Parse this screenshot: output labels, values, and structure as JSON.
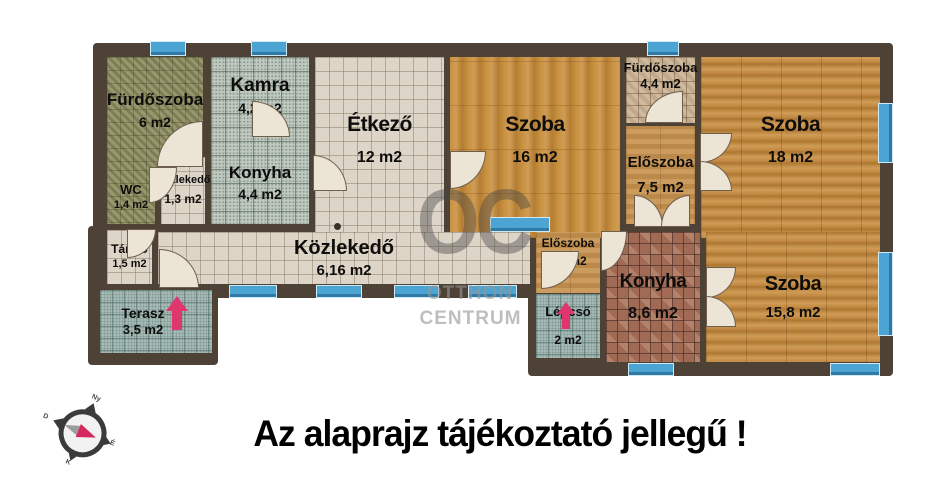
{
  "plan": {
    "rooms": {
      "furdoszoba6": {
        "name": "Fürdőszoba",
        "area": "6 m2"
      },
      "kamra": {
        "name": "Kamra",
        "area": "4,2 m2"
      },
      "etkezo": {
        "name": "Étkező",
        "area": "12 m2"
      },
      "szoba16": {
        "name": "Szoba",
        "area": "16 m2"
      },
      "furdoszoba44": {
        "name": "Fürdőszoba",
        "area": "4,4 m2"
      },
      "szoba18": {
        "name": "Szoba",
        "area": "18 m2"
      },
      "wc": {
        "name": "WC",
        "area": "1,4 m2"
      },
      "kozlekedo13": {
        "name": "Közlekedő",
        "area": "1,3 m2"
      },
      "konyha44": {
        "name": "Konyha",
        "area": "4,4 m2"
      },
      "eloszoba75": {
        "name": "Előszoba",
        "area": "7,5 m2"
      },
      "tarolo": {
        "name": "Tároló",
        "area": "1,5 m2"
      },
      "kozlekedo616": {
        "name": "Közlekedő",
        "area": "6,16 m2"
      },
      "terasz": {
        "name": "Terasz",
        "area": "3,5 m2"
      },
      "eloszoba26": {
        "name": "Előszoba",
        "area": "2,6 m2"
      },
      "lepcso": {
        "name": "Lépcső",
        "area": "2 m2"
      },
      "konyha86": {
        "name": "Konyha",
        "area": "8,6 m2"
      },
      "szoba158": {
        "name": "Szoba",
        "area": "15,8 m2"
      }
    },
    "watermark": {
      "monogram": "OC",
      "line1": "OTTHON",
      "line2": "CENTRUM"
    },
    "compass": {
      "n": "Ny",
      "e": "É",
      "s": "K",
      "w": "D"
    },
    "disclaimer": "Az alaprajz tájékoztató jellegű !",
    "colors": {
      "wall": "#4e4237",
      "window_blue": "#4ba4d2",
      "arrow_pink": "#e0366e",
      "door_cream": "#ece4d4"
    }
  }
}
